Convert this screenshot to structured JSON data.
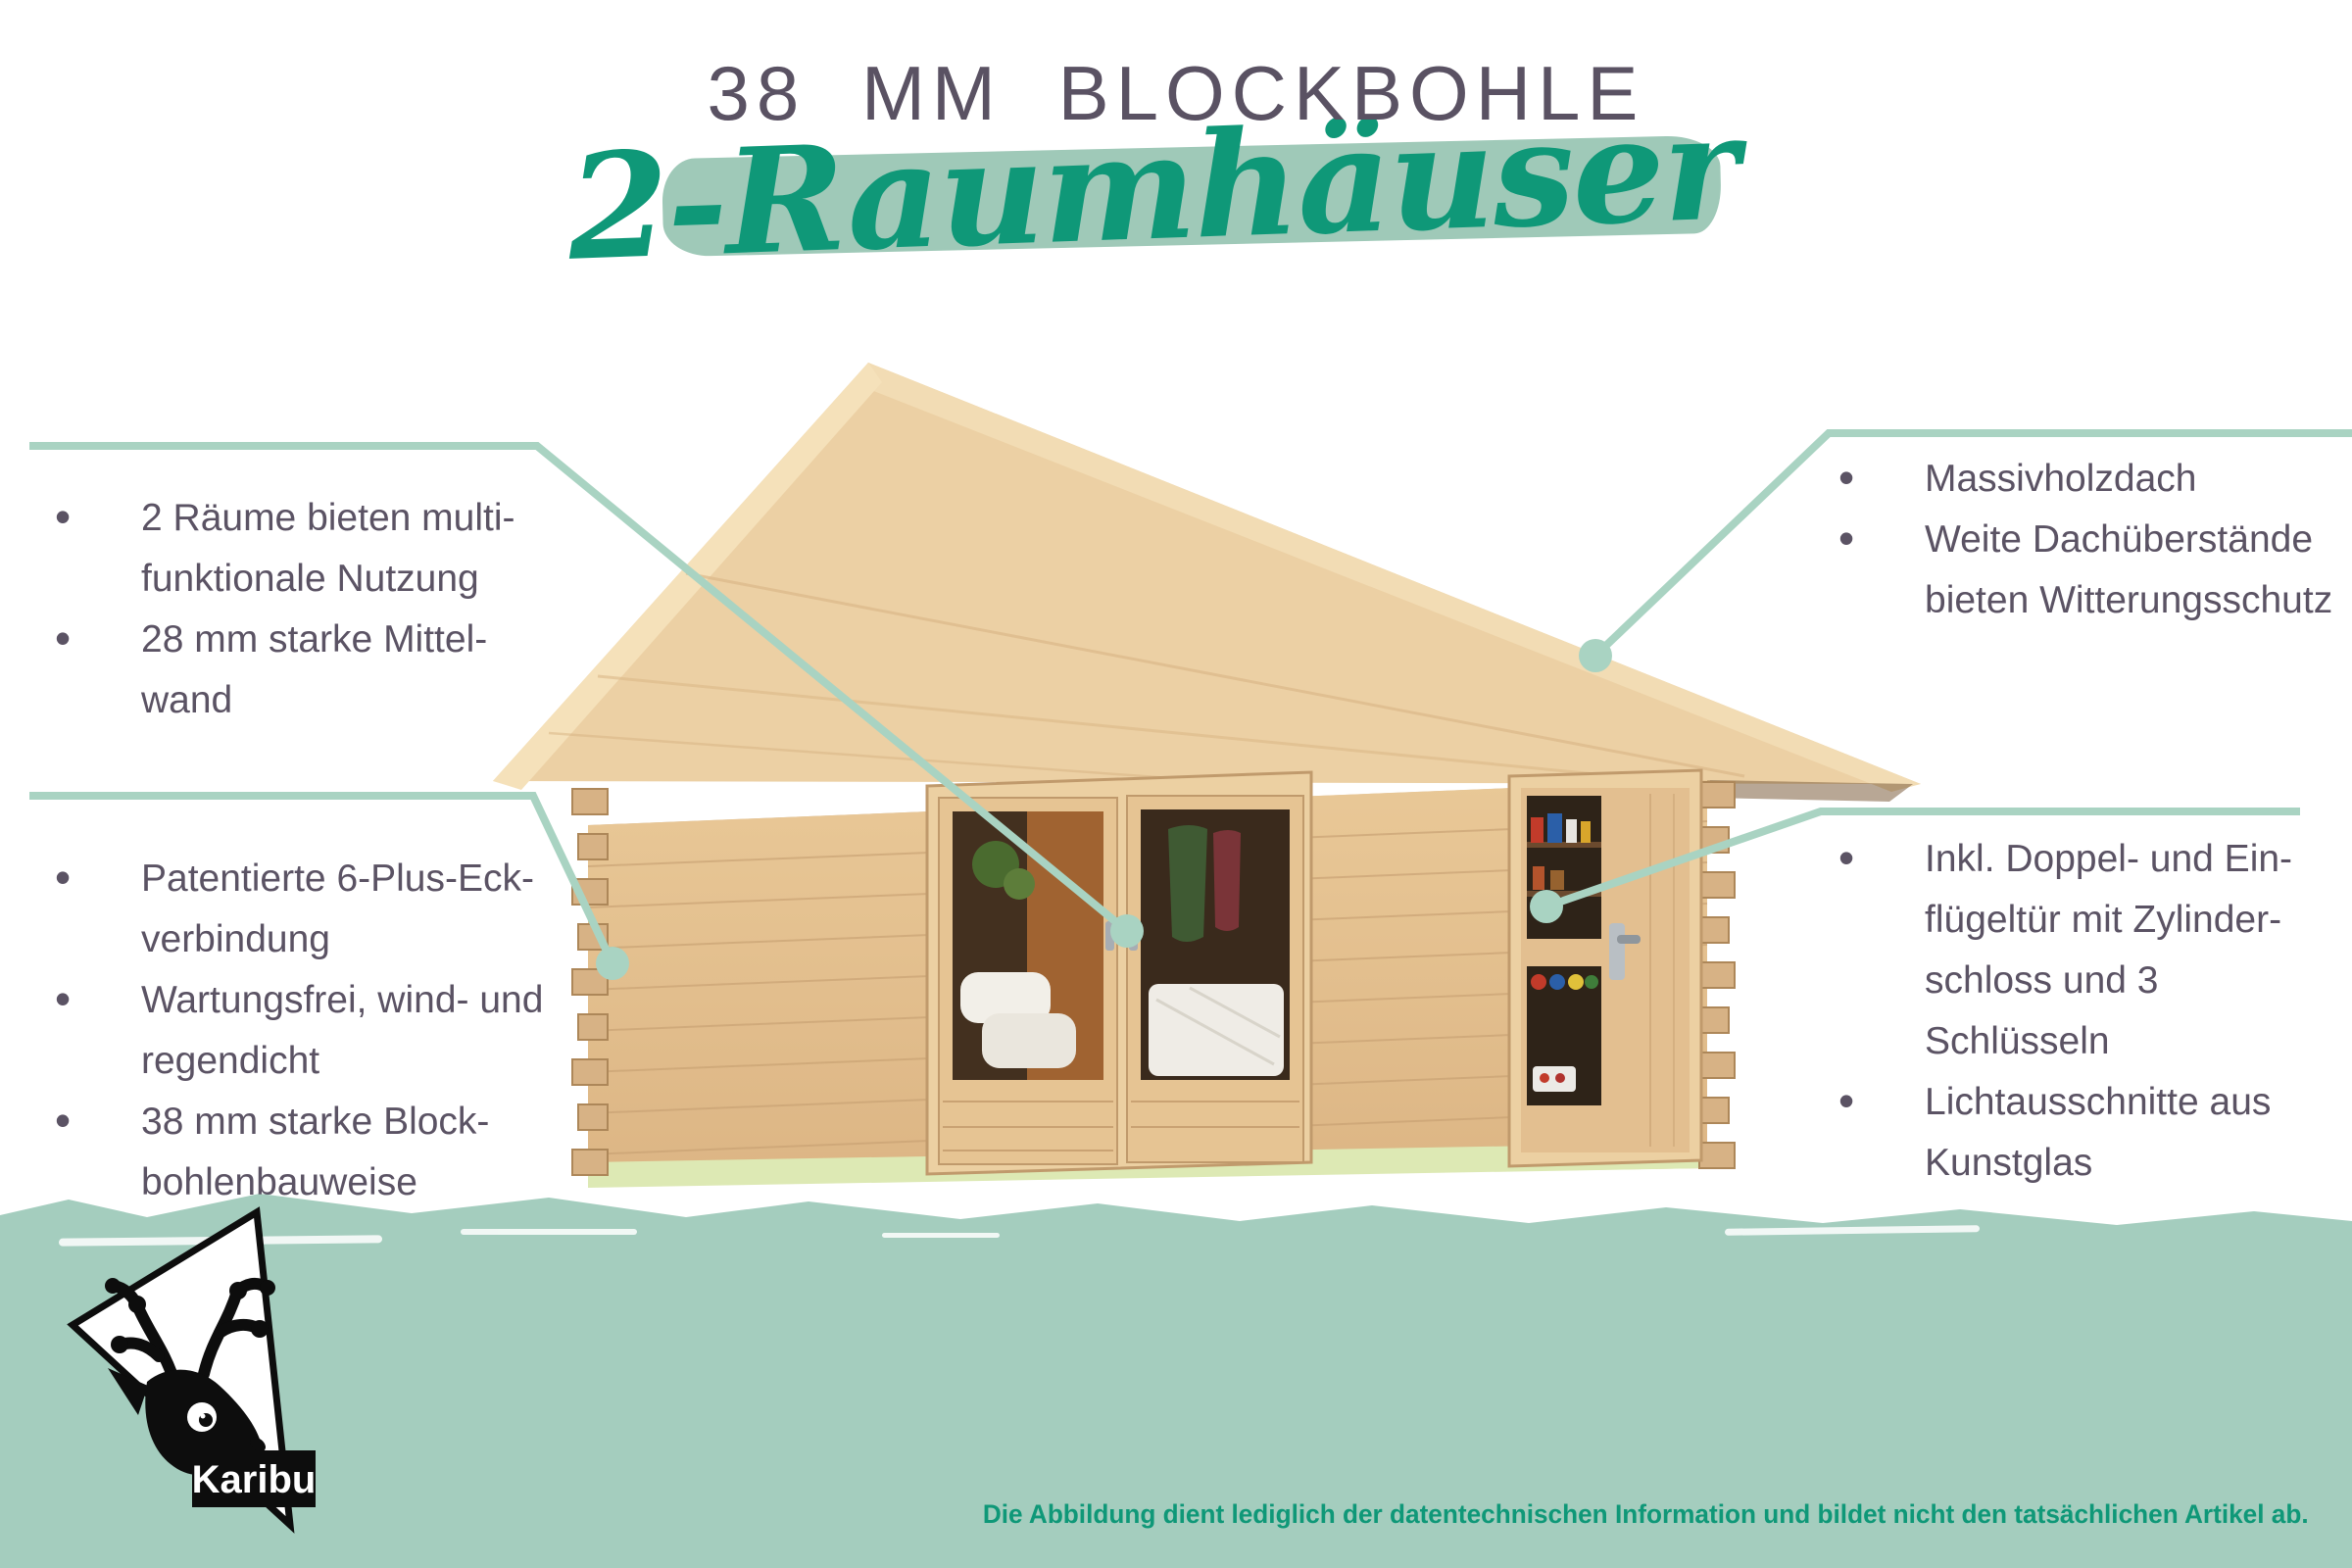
{
  "header": {
    "title": "38 MM BLOCKBOHLE",
    "subtitle": "2-Raumhäuser"
  },
  "callouts": {
    "top_left": {
      "items": [
        "2 Räume bieten multi-\nfunktionale Nutzung",
        "28 mm starke Mittel-\nwand"
      ]
    },
    "bottom_left": {
      "items": [
        "Patentierte 6-Plus-Eck-\nverbindung",
        "Wartungsfrei, wind- und\nregendicht",
        "38 mm starke Block-\nbohlenbauweise"
      ]
    },
    "top_right": {
      "items": [
        "Massivholzdach",
        "Weite Dachüberstände\nbieten Witterungsschutz"
      ]
    },
    "bottom_right": {
      "items": [
        "Inkl. Doppel- und Ein-\nflügeltür mit Zylinder-\nschloss und 3\nSchlüsseln",
        "Lichtausschnitte aus\nKunstglas"
      ]
    }
  },
  "footer": {
    "disclaimer": "Die Abbildung dient lediglich der datentechnischen Information und bildet nicht den tatsächlichen Artikel ab."
  },
  "logo": {
    "brand": "Karibu",
    "icon": "reindeer-head-triangle"
  },
  "colors": {
    "accent_green": "#0f9878",
    "mint_band": "#a4cdbe",
    "mint_line": "#a9d3c2",
    "swoosh_mint": "#9fc9b8",
    "text_gray_purple": "#5b5364",
    "wood_light": "#ecd0a4",
    "wood_wall": "#e3bf92"
  }
}
